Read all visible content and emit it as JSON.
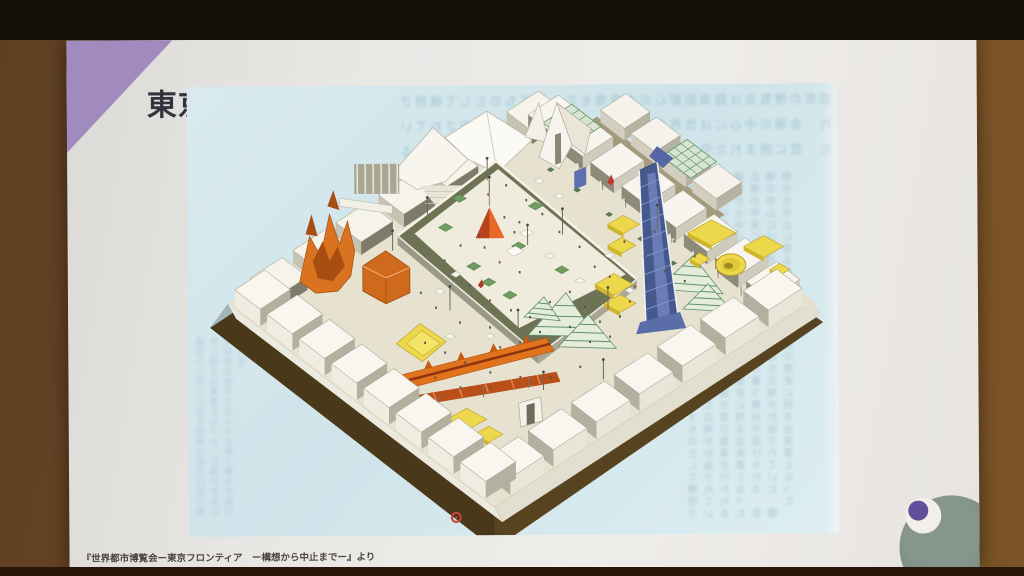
{
  "photo": {
    "description": "Photograph of a presentation slide projected on a screen in a dark room"
  },
  "room": {
    "band_top": "#150f09",
    "wall_left": "#6f4b28",
    "wall_right": "#7b5426",
    "floor": "#5d3d1e"
  },
  "slide": {
    "title": "東京メトロポリスプラザ",
    "caption": "『世界都市博覧会ー東京フロンティア　ー構想から中止までー』より",
    "accent_color": "#a18abd",
    "background_color": "#eae8e5"
  },
  "illustration": {
    "description": "Isometric cutaway drawing of the Tokyo Metropolis Plaza: a square plaza enclosed by white bastion walls on a brown base, central raised platform with red pyramid and planters, orange canyon structure, long orange serpentine pavilion, yellow pavilions and round amphitheaters, green striped tent roofs, blue diagonal ramp, tiny visitors",
    "page_color": "#d3e6ec",
    "palette": {
      "base_brown": "#57431f",
      "ground": "#e7e2cf",
      "wall_top": "#f7f5ee",
      "wall_light": "#eeeade",
      "wall_mid": "#c6c3b2",
      "wall_dark": "#7e7b6b",
      "platform_ring": "#6e7354",
      "platform_top": "#efecdd",
      "planter_green": "#6f9c60",
      "pyramid_dark": "#b8421a",
      "pyramid_light": "#e8682a",
      "orange": "#d9731f",
      "orange_dark": "#a84e12",
      "dragon": "#e2731d",
      "dragon_dark": "#b9501a",
      "ridge_red": "#8f3210",
      "yellow": "#ecd84a",
      "yellow_dark": "#b89d23",
      "green_stripe": "#5f9168",
      "green_fill": "#e4ecdc",
      "lattice_green": "#639563",
      "blue": "#46598f",
      "blue_light": "#8b9cc9",
      "people": "#55534a",
      "red_marker": "#c9443a"
    },
    "bleed_lines": [
      "都市の博覧会は臨海副都心の未来像を広く示すものとして構想され",
      "会場の中心には世界の都市文化を集めた広場が計画されていた",
      "壁に囲まれた空間には各国の展示施設が並び催事が行われる",
      "構想から中止に至る経緯は都市計画の歴史に残る出来事となった",
      "広場の中央には祝祭の塔が立ち人々が集う舞台が設けられる"
    ]
  },
  "mascot": {
    "body_color": "#87968c",
    "eye_color": "#f2efe9",
    "pupil_color": "#60509a"
  }
}
